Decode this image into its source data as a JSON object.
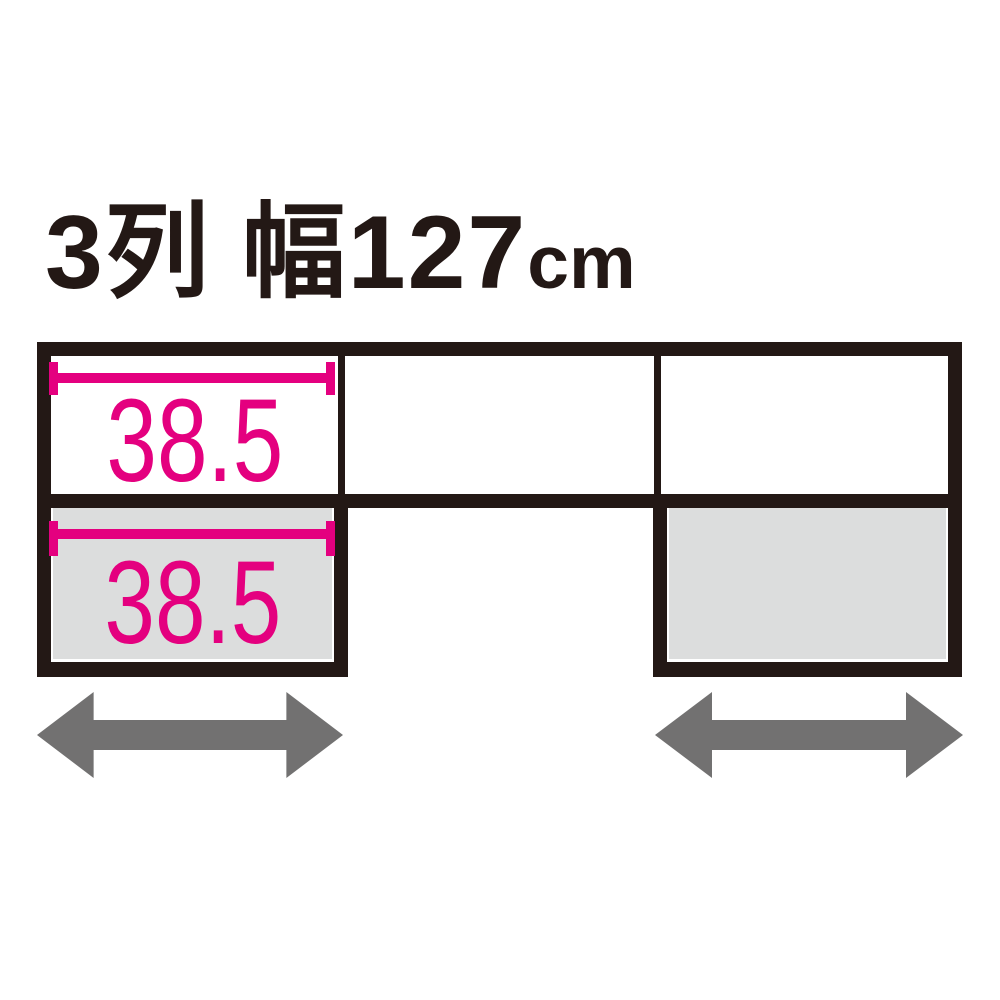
{
  "title": {
    "text": "3列 幅127cm",
    "main": "3列 幅127",
    "unit": "cm"
  },
  "colors": {
    "ink": "#231815",
    "pink": "#e4007f",
    "gray-fill": "#dcdddd",
    "arrow": "#727171",
    "bg": "#ffffff"
  },
  "diagram": {
    "description": "3-column cabinet unit, total width 127 cm; top row has 3 sections, bottom row has left and right slide-out units (gray) with the centre open",
    "top_row": {
      "columns": 3,
      "dimension": {
        "value": "38.5",
        "applies_to": "left column width"
      }
    },
    "bottom_row": {
      "left_unit": {
        "filled": "gray",
        "dimension": {
          "value": "38.5"
        }
      },
      "right_unit": {
        "filled": "gray"
      }
    },
    "icons": {
      "left_arrow": "double-headed-horizontal-arrow",
      "right_arrow": "double-headed-horizontal-arrow"
    }
  }
}
